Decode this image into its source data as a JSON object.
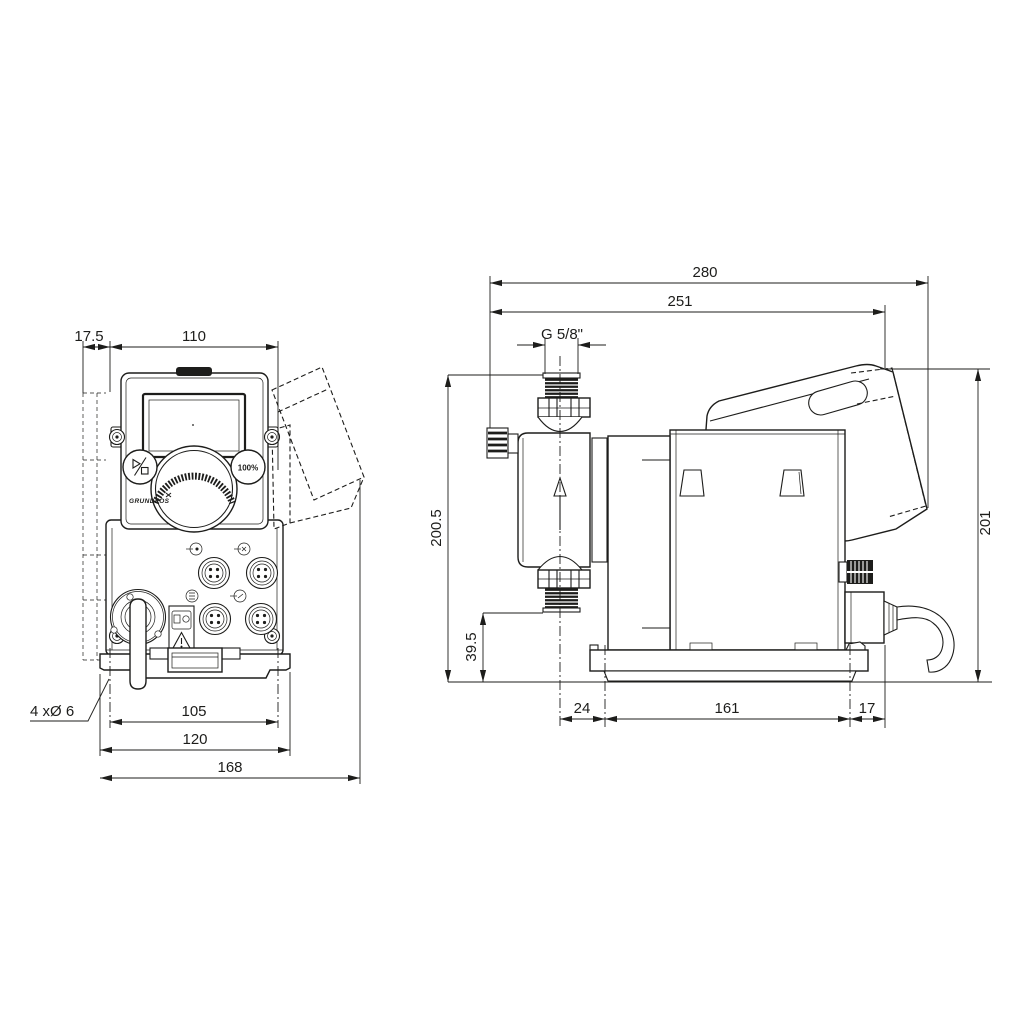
{
  "front_view": {
    "dim_offset": "17.5",
    "dim_width_top": "110",
    "dim_hole_spacing": "105",
    "dim_plate_width": "120",
    "dim_overall_width": "168",
    "label_mounting_holes": "4 xØ 6",
    "button_max_label": "100%",
    "logo_text": "GRUNDFOS",
    "icons": {
      "start_stop": "play-stop-icon",
      "max_capacity": "100%-icon",
      "connectors": "m12-connector-sockets",
      "warning": "warning-triangle-icon"
    }
  },
  "side_view": {
    "dim_overall_depth": "280",
    "dim_depth_to_hood": "251",
    "dim_thread": "G 5/8\"",
    "dim_height_overall": "200.5",
    "dim_valve_height": "39.5",
    "dim_height_rear": "201",
    "dim_front_offset": "24",
    "dim_base_length": "161",
    "dim_rear_offset": "17",
    "flow_direction": "up"
  },
  "line_color": "#1d1d1b"
}
